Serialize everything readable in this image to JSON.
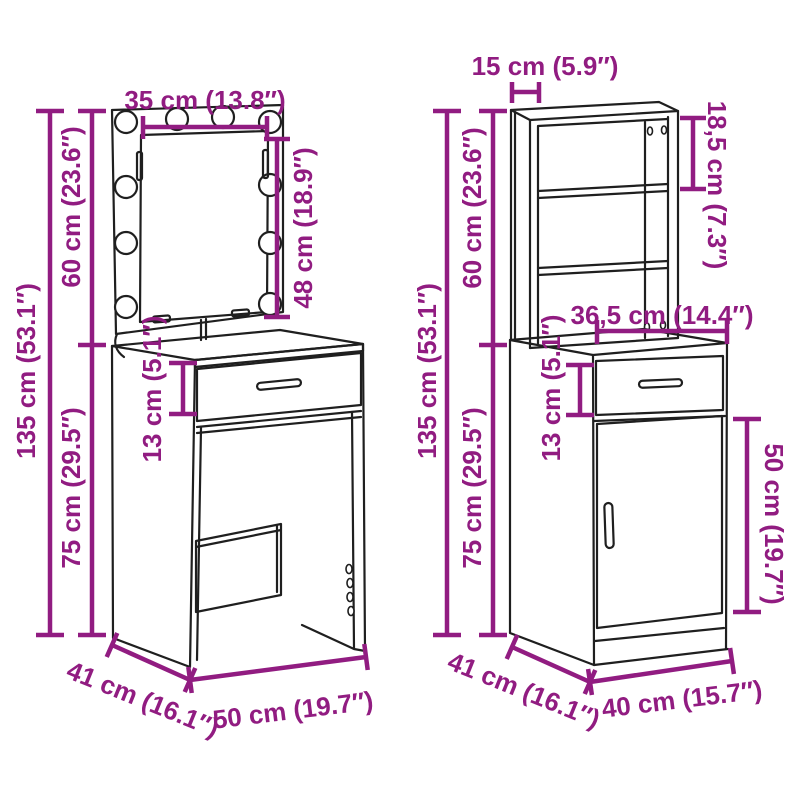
{
  "colors": {
    "dimension_annotation": "#911c81",
    "line_art": "#1f1f1f",
    "background": "#ffffff"
  },
  "left_item": {
    "dimensions": {
      "mirror_width": "35 cm (13.8″)",
      "mirror_column_height": "60 cm (23.6″)",
      "total_height": "135 cm (53.1″)",
      "table_height": "75 cm (29.5″)",
      "mirror_inner_height": "48 cm (18.9″)",
      "drawer_front_height": "13 cm (5.1″)",
      "depth": "41 cm (16.1″)",
      "width": "50 cm (19.7″)"
    }
  },
  "right_item": {
    "dimensions": {
      "top_unit_depth": "15 cm (5.9″)",
      "top_shelf_spacing": "18,5 cm (7.3″)",
      "top_unit_height": "60 cm (23.6″)",
      "total_height": "135 cm (53.1″)",
      "base_unit_height": "75 cm (29.5″)",
      "drawer_width": "36,5 cm (14.4″)",
      "drawer_front_height": "13 cm (5.1″)",
      "door_height": "50 cm (19.7″)",
      "depth": "41 cm (16.1″)",
      "width": "40 cm (15.7″)"
    }
  }
}
